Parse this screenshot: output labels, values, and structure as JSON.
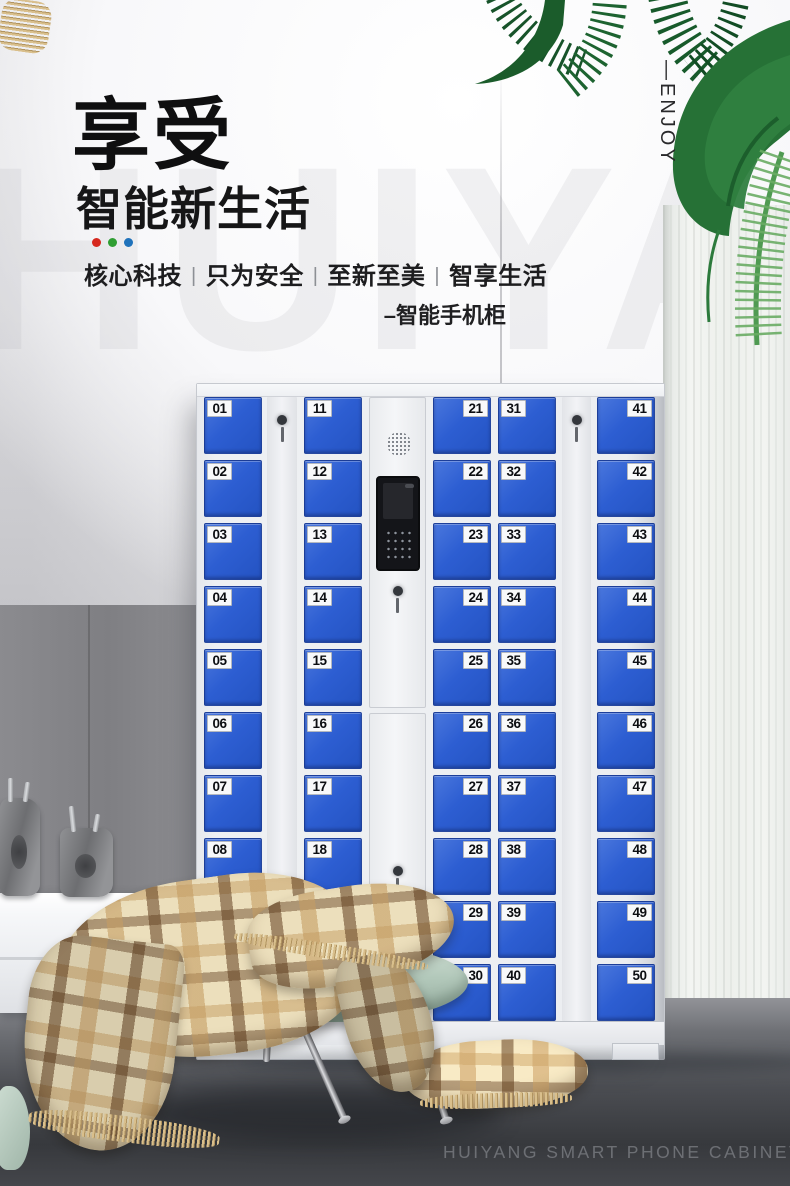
{
  "page": {
    "watermark": "HUIYANG",
    "caption": "HUIYANG SMART PHONE CABINET"
  },
  "header": {
    "title": "享受",
    "subtitle": "智能新生活",
    "accent_dots": [
      "#d6281e",
      "#2f9e33",
      "#1f72bb"
    ],
    "tagline_parts": [
      "核心科技",
      "只为安全",
      "至新至美",
      "智享生活"
    ],
    "tagline_separator": "|",
    "product_note": "–智能手机柜",
    "side_label": "—ENJOY"
  },
  "cabinet": {
    "door_color": "#2d5ed2",
    "columns": [
      {
        "label_side": "left",
        "numbers": [
          "01",
          "02",
          "03",
          "04",
          "05",
          "06",
          "07",
          "08",
          "09",
          "10"
        ]
      },
      {
        "label_side": "left",
        "numbers": [
          "11",
          "12",
          "13",
          "14",
          "15",
          "16",
          "17",
          "18",
          "19",
          "20"
        ]
      },
      {
        "label_side": "right",
        "numbers": [
          "21",
          "22",
          "23",
          "24",
          "25",
          "26",
          "27",
          "28",
          "29",
          "30"
        ]
      },
      {
        "label_side": "left",
        "numbers": [
          "31",
          "32",
          "33",
          "34",
          "35",
          "36",
          "37",
          "38",
          "39",
          "40"
        ]
      },
      {
        "label_side": "right",
        "numbers": [
          "41",
          "42",
          "43",
          "44",
          "45",
          "46",
          "47",
          "48",
          "49",
          "50"
        ]
      }
    ]
  }
}
